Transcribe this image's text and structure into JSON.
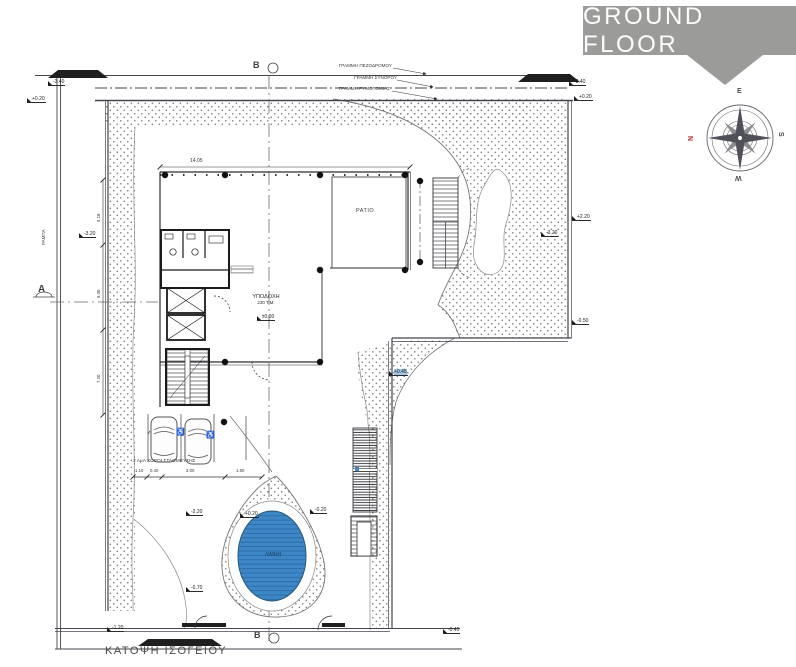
{
  "header": {
    "title": "GROUND FLOOR"
  },
  "compass": {
    "top": "E",
    "left": "N",
    "right": "S",
    "bottom": "W"
  },
  "boundary_labels": {
    "pedestrian": "ΓΡΑΜΜΗ ΠΕΖΟΔΡΟΜΟΥ",
    "border": "ΓΡΑΜΜΗ ΣΥΝΟΡΟΥ",
    "alignment": "ΓΡΑΜΜΗ ΡΥΜΟΤΟΜΙΑΣ"
  },
  "rooms": {
    "patio": "PATIO",
    "reception_name": "ΥΠΟΔΟΧΗ",
    "reception_area": "230 Τ.Μ.",
    "reception_level": "±0.00",
    "pool": "ΛΙΜΝΗ",
    "parking": "2 ΑμΑ ΧΩΡΟΙ ΣΤΑΘΜΕΥΣΗΣ",
    "ramp": "ΡΑΜΠΑ"
  },
  "sections": {
    "a": "A",
    "b": "B"
  },
  "plan_title": "ΚΑΤΟΨΗ ΙΣΟΓΕΙΟΥ",
  "dimensions": {
    "building_width": "14.05",
    "parking": [
      "1.10",
      "0.40",
      "3.00",
      "1.80"
    ],
    "left": [
      "9.18",
      "6.30",
      "7.20"
    ]
  },
  "levels": [
    {
      "v": "-3.40"
    },
    {
      "v": "+0.20"
    },
    {
      "v": "-3.40"
    },
    {
      "v": "+0.20"
    },
    {
      "v": "+2.20"
    },
    {
      "v": "-3.20"
    },
    {
      "v": "-3.20"
    },
    {
      "v": "-0.50"
    },
    {
      "v": "+0.45"
    },
    {
      "v": "+0.20"
    },
    {
      "v": "-0.20"
    },
    {
      "v": "-2.20"
    },
    {
      "v": "-0.70"
    },
    {
      "v": "-1.20"
    },
    {
      "v": "-0.45"
    }
  ],
  "colors": {
    "banner": "#9b9b99",
    "pool": "#3e87c6",
    "north_red": "#bf2b2b",
    "line": "#4a4a52"
  }
}
